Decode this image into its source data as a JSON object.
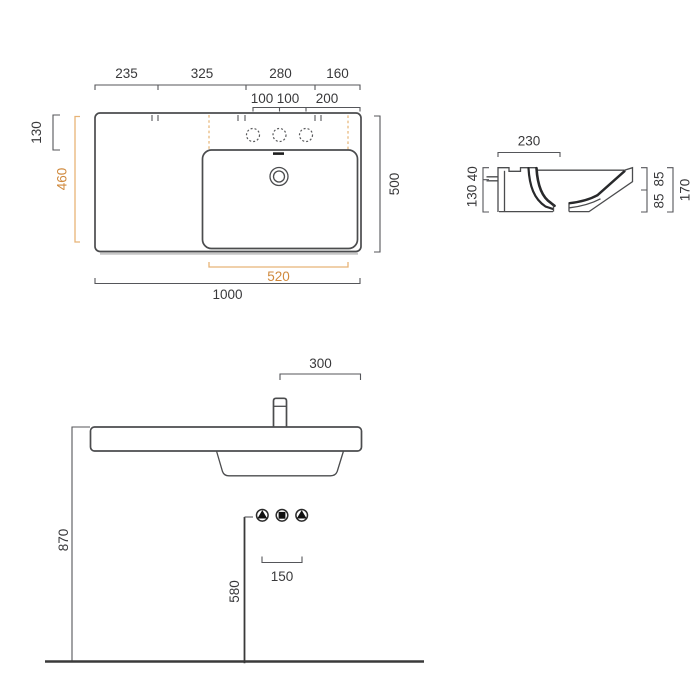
{
  "colors": {
    "line": "#4b4c4e",
    "dimension_text": "#39393b",
    "accent_text": "#d08a3e",
    "accent_line": "#e7b377",
    "floor_line": "#3a3a3a",
    "shadow": "#c6c6c6"
  },
  "top_view": {
    "width_segments": [
      "235",
      "325",
      "280",
      "160"
    ],
    "tap_hole_segments": [
      "100",
      "100",
      "200"
    ],
    "back_edge_to_basin": "130",
    "basin_area_depth": "460",
    "overall_depth": "500",
    "basin_area_width": "520",
    "overall_width": "1000"
  },
  "section_view": {
    "basin_opening_depth": "230",
    "rim_to_inlet": "40",
    "inlet_to_base": "130",
    "upper_height": "85",
    "lower_height": "85",
    "overall_height": "170"
  },
  "front_view": {
    "tap_to_edge": "300",
    "rim_height": "870",
    "drain_connection_height": "580",
    "connection_spacing": "150"
  },
  "icons": {
    "left_supply": "water-supply-triangle",
    "center_waste": "waste-outlet-square",
    "right_supply": "water-supply-triangle"
  }
}
